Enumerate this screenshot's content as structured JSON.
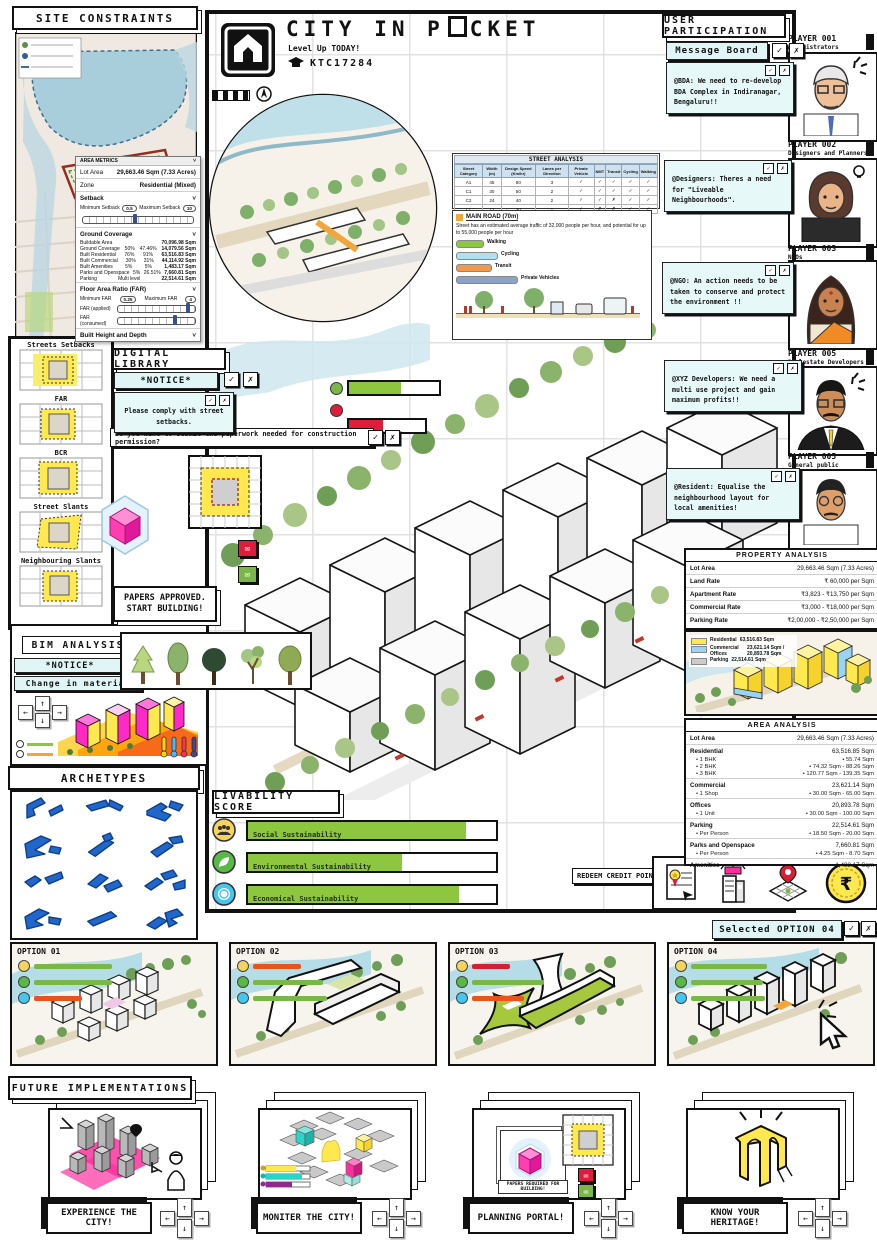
{
  "ui": {
    "check": "✓",
    "cross": "✗",
    "caret": "˅",
    "envelope": "✉",
    "bullet": "•"
  },
  "colors": {
    "accent_green": "#7ab648",
    "accent_red": "#d61f36",
    "accent_orange": "#e8541b",
    "cyan_box": "#e7f8f8",
    "yellow": "#ffe94e",
    "archetype_blue": "#2166c9"
  },
  "header": {
    "title_pre": "CITY IN P",
    "title_post": "CKET",
    "subtitle": "Level Up TODAY!",
    "code": "KTC17284"
  },
  "site_constraints": {
    "title": "SITE CONSTRAINTS"
  },
  "area_metrics": {
    "title": "AREA METRICS",
    "rows": [
      {
        "label": "Lot Area",
        "value": "29,663.46 Sqm (7.33 Acres)"
      },
      {
        "label": "Zone",
        "value": "Residential (Mixed)"
      }
    ],
    "setback_label": "Setback",
    "min_setback_label": "Minimum Setback",
    "min_setback": "0.5",
    "max_setback_label": "Maximum Setback",
    "max_setback": "10",
    "ground_label": "Ground Coverage",
    "ground_rows": [
      {
        "label": "Buildable Area",
        "a": "",
        "b": "",
        "v": "70,096.98 Sqm"
      },
      {
        "label": "Ground Coverage",
        "a": "50%",
        "b": "47.46%",
        "v": "14,079.56 Sqm"
      },
      {
        "label": "Built Residential",
        "a": "76%",
        "b": "91%",
        "v": "63,516.83 Sqm"
      },
      {
        "label": "Built Commercial",
        "a": "30%",
        "b": "31%",
        "v": "44,114.92 Sqm"
      },
      {
        "label": "Built Amenities",
        "a": "5%",
        "b": "5%",
        "v": "1,483.17 Sqm"
      },
      {
        "label": "Parks and Openspace",
        "a": "5%",
        "b": "26.51%",
        "v": "7,660.81 Sqm"
      },
      {
        "label": "Parking",
        "a": "Multi level",
        "b": "",
        "v": "22,514.61 Sqm"
      }
    ],
    "far_label": "Floor Area Ratio (FAR)",
    "min_far_label": "Minimum FAR",
    "min_far": "0.25",
    "max_far_label": "Maximum FAR",
    "max_far": "4",
    "far_applied_label": "FAR (applied)",
    "far_consumed_label": "FAR (consumed)",
    "height_label": "Built Height and Depth",
    "bh_label": "Building Height",
    "bh": "60",
    "bd_label": "Building Depth",
    "bd": "16"
  },
  "street_analysis": {
    "title": "STREET ANALYSIS",
    "columns": [
      "Street Category",
      "Width (m)",
      "Design Speed (Km/hr)",
      "Lanes per Direction",
      "Private Vehicle",
      "NMT",
      "Transit",
      "Cycling",
      "Walking"
    ],
    "rows": [
      [
        "A1",
        "45",
        "60",
        "3",
        "✓",
        "✓",
        "✓",
        "✓",
        "✓"
      ],
      [
        "C1",
        "30",
        "50",
        "2",
        "✓",
        "✓",
        "✓",
        "✓",
        "✓"
      ],
      [
        "C2",
        "24",
        "40",
        "2",
        "✓",
        "✓",
        "✗",
        "✓",
        "✓"
      ],
      [
        "L1",
        "12",
        "30",
        "1",
        "✓",
        "✗",
        "✗",
        "✓",
        "✓"
      ]
    ]
  },
  "street_section": {
    "title": "MAIN ROAD (70m)",
    "desc": "Street has an estimated average traffic of 32,000 people per hour, and potential for up to 55,000 people per hour",
    "legend": [
      {
        "label": "Walking",
        "color": "#8dc63f"
      },
      {
        "label": "Cycling",
        "color": "#aee0f2"
      },
      {
        "label": "Transit",
        "color": "#f09a4e"
      },
      {
        "label": "Private Vehicles",
        "color": "#8ba3c7"
      }
    ]
  },
  "user_participation": {
    "title": "USER PARTICIPATION",
    "board_label": "Message Board",
    "messages": [
      {
        "text": "@BDA: We need to re-develop BDA Complex in Indiranagar, Bengaluru!!"
      },
      {
        "text": "@Designers: Theres a need for \"Liveable Neighbourhoods\"."
      },
      {
        "text": "@NGO: An action needs to be taken to conserve and protect the environment !!"
      },
      {
        "text": "@XYZ Developers: We need a multi use project and gain maximum profits!!"
      },
      {
        "text": "@Resident: Equalise the neighbourhood layout for local amenities!"
      }
    ]
  },
  "players": [
    {
      "id": "PLAYER 001",
      "role": "Administrators"
    },
    {
      "id": "PLAYER 002",
      "role": "Designers and Planners"
    },
    {
      "id": "PLAYER 003",
      "role": "NGOs"
    },
    {
      "id": "PLAYER 005",
      "role": "Realestate Developers"
    },
    {
      "id": "PLAYER 005",
      "role": "General public"
    }
  ],
  "sidebar": {
    "items": [
      {
        "label": "Streets Setbacks"
      },
      {
        "label": "FAR"
      },
      {
        "label": "BCR"
      },
      {
        "label": "Street Slants"
      },
      {
        "label": "Neighbouring Slants"
      }
    ]
  },
  "digital_library": {
    "title": "DIGITAL LIBRARY",
    "notice": "*NOTICE*",
    "message": "Please comply with street setbacks.",
    "question": "Do you want to submit the paperwork needed for construction permission?"
  },
  "papers_approved": "PAPERS APPROVED. START BUILDING!",
  "bim": {
    "title": "BIM ANALYSIS",
    "notice": "*NOTICE*",
    "change": "Change in material"
  },
  "archetypes": {
    "title": "ARCHETYPES"
  },
  "livability": {
    "title": "LIVABILITY SCORE",
    "items": [
      {
        "label": "Social Sustainability",
        "value": 88
      },
      {
        "label": "Environmental Sustainability",
        "value": 62
      },
      {
        "label": "Economical Sustainability",
        "value": 85
      }
    ]
  },
  "property_analysis": {
    "title": "PROPERTY ANALYSIS",
    "rows": [
      {
        "label": "Lot Area",
        "value": "29,663.46 Sqm (7.33 Acres)"
      },
      {
        "label": "Land Rate",
        "value": "₹ 60,000 per Sqm"
      },
      {
        "label": "Apartment Rate",
        "value": "₹3,823 - ₹13,750 per Sqm"
      },
      {
        "label": "Commercial Rate",
        "value": "₹3,000 - ₹18,000 per Sqm"
      },
      {
        "label": "Parking Rate",
        "value": "₹2,00,000 - ₹2,50,000 per Sqm"
      }
    ],
    "legend": [
      {
        "label": "Residential",
        "value": "63,516.83 Sqm",
        "color": "#ffe94e"
      },
      {
        "label": "Commercial Offices",
        "value": "23,621.14 Sqm / 20,893.78 Sqm",
        "color": "#9ad4f5"
      },
      {
        "label": "Parking",
        "value": "22,514.61 Sqm",
        "color": "#cccccc"
      }
    ]
  },
  "area_analysis": {
    "title": "AREA ANALYSIS",
    "groups": [
      {
        "label": "Lot Area",
        "value": "29,663.46 Sqm (7.33 Acres)"
      },
      {
        "label": "Residential",
        "value": "63,516.85 Sqm",
        "s1l": "• 1 BHK",
        "s1v": "• 55.74 Sqm",
        "s2l": "• 2 BHK",
        "s2v": "• 74.32 Sqm - 88.26 Sqm",
        "s3l": "• 3 BHK",
        "s3v": "• 120.77 Sqm - 139.35 Sqm"
      },
      {
        "label": "Commercial",
        "value": "23,621.14 Sqm",
        "s1l": "• 1 Shop",
        "s1v": "• 30.00 Sqm - 65.00 Sqm"
      },
      {
        "label": "Offices",
        "value": "20,893.78 Sqm",
        "s1l": "• 1 Unit",
        "s1v": "• 30.00 Sqm - 100.00 Sqm"
      },
      {
        "label": "Parking",
        "value": "22,514.61 Sqm",
        "s1l": "• Per Person",
        "s1v": "• 18.50 Sqm - 20.00 Sqm"
      },
      {
        "label": "Parks and Openspace",
        "value": "7,660.81 Sqm",
        "s1l": "• Per Person",
        "s1v": "• 4.25 Sqm - 8.70 Sqm"
      },
      {
        "label": "Amenities",
        "value": "1,483.17 Sqm"
      }
    ]
  },
  "redeem": {
    "label": "REDEEM CREDIT POINTS!",
    "coin_symbol": "₹"
  },
  "selected_option": {
    "label": "Selected OPTION 04"
  },
  "options": [
    {
      "label": "OPTION 01",
      "scores": [
        {
          "color": "#7ab648",
          "w": 78
        },
        {
          "color": "#7ab648",
          "w": 78
        },
        {
          "color": "#e8541b",
          "w": 48
        }
      ]
    },
    {
      "label": "OPTION 02",
      "scores": [
        {
          "color": "#e8541b",
          "w": 48
        },
        {
          "color": "#7ab648",
          "w": 70
        },
        {
          "color": "#7ab648",
          "w": 74
        }
      ]
    },
    {
      "label": "OPTION 03",
      "scores": [
        {
          "color": "#d61f36",
          "w": 38
        },
        {
          "color": "#7ab648",
          "w": 72
        },
        {
          "color": "#e8541b",
          "w": 52
        }
      ]
    },
    {
      "label": "OPTION 04",
      "scores": [
        {
          "color": "#7ab648",
          "w": 76
        },
        {
          "color": "#7ab648",
          "w": 72
        },
        {
          "color": "#7ab648",
          "w": 74
        }
      ]
    }
  ],
  "future": {
    "title": "FUTURE IMPLEMENTATIONS",
    "cards": [
      {
        "caption": "EXPERIENCE THE CITY!"
      },
      {
        "caption": "MONITER THE CITY!"
      },
      {
        "caption": "PLANNING PORTAL!"
      },
      {
        "caption": "KNOW YOUR HERITAGE!"
      }
    ],
    "planning_note": "PAPERS REQUIRED FOR BUILDING!"
  }
}
